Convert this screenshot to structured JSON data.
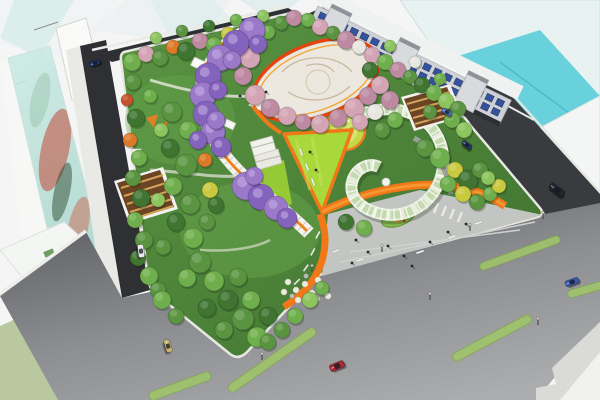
{
  "scene": {
    "description": "Aerial architectural rendering of an urban pocket-park masterplan at a street intersection",
    "palette": {
      "parkBaseLight": "#5a9442",
      "parkBaseDark": "#3f7230",
      "asphaltDark": "#2f3033",
      "boulevardDark": "#66676b",
      "boulevardLight": "#a9aaac",
      "lawnLime": "#a9d83a",
      "pathOrange": "#f07818",
      "ringRed": "#e8430f",
      "plazaWhite": "#ece8df",
      "plazaGray": "#c2c5c1",
      "glassTeal": "#62cfd9",
      "glassPale": "#e8f3f1",
      "median": "#9fc36b",
      "timberRoof": "#6b4423",
      "timberStripe": "#d2a35c",
      "g1": "#5a9440",
      "g2": "#6fae4c",
      "g3": "#3f7431",
      "g4": "#8cc45e",
      "yl": "#c9c93f",
      "or": "#dd7a28",
      "rs": "#c4522a",
      "pk": "#d3a4b4",
      "pk2": "#bd8aa2",
      "wh": "#e7e6df",
      "vi": "#9a79c9",
      "vi2": "#8463bd"
    },
    "terrace_building": {
      "cols": 18,
      "rows": 2,
      "window_color": "#27489a"
    },
    "trees": [
      [
        132,
        62,
        9,
        "g2"
      ],
      [
        146,
        54,
        8,
        "pk"
      ],
      [
        160,
        58,
        8,
        "g1"
      ],
      [
        173,
        47,
        7,
        "or"
      ],
      [
        186,
        51,
        9,
        "g3"
      ],
      [
        200,
        41,
        8,
        "pk2"
      ],
      [
        214,
        45,
        8,
        "g2"
      ],
      [
        228,
        34,
        7,
        "yl"
      ],
      [
        241,
        38,
        8,
        "g1"
      ],
      [
        255,
        28,
        8,
        "pk"
      ],
      [
        268,
        32,
        7,
        "g2"
      ],
      [
        281,
        23,
        7,
        "g1"
      ],
      [
        294,
        18,
        8,
        "pk2"
      ],
      [
        156,
        38,
        6,
        "g4"
      ],
      [
        182,
        31,
        6,
        "g1"
      ],
      [
        209,
        26,
        6,
        "g3"
      ],
      [
        236,
        20,
        6,
        "g2"
      ],
      [
        263,
        16,
        6,
        "g4"
      ],
      [
        308,
        20,
        7,
        "g2"
      ],
      [
        320,
        27,
        8,
        "pk"
      ],
      [
        333,
        33,
        7,
        "g1"
      ],
      [
        346,
        40,
        9,
        "pk2"
      ],
      [
        359,
        47,
        7,
        "wh"
      ],
      [
        372,
        55,
        8,
        "pk"
      ],
      [
        385,
        62,
        8,
        "g2"
      ],
      [
        398,
        70,
        8,
        "pk2"
      ],
      [
        410,
        77,
        7,
        "g1"
      ],
      [
        422,
        85,
        8,
        "g3"
      ],
      [
        434,
        93,
        8,
        "g2"
      ],
      [
        446,
        101,
        8,
        "g4"
      ],
      [
        458,
        109,
        8,
        "g1"
      ],
      [
        390,
        46,
        6,
        "g4"
      ],
      [
        415,
        62,
        6,
        "wh"
      ],
      [
        440,
        79,
        6,
        "g2"
      ],
      [
        250,
        58,
        10,
        "pk"
      ],
      [
        243,
        76,
        9,
        "pk2"
      ],
      [
        255,
        95,
        10,
        "pk"
      ],
      [
        270,
        108,
        9,
        "pk2"
      ],
      [
        287,
        116,
        9,
        "pk"
      ],
      [
        303,
        122,
        8,
        "pk2"
      ],
      [
        320,
        124,
        9,
        "pk"
      ],
      [
        338,
        118,
        9,
        "pk2"
      ],
      [
        354,
        108,
        10,
        "pk"
      ],
      [
        368,
        96,
        9,
        "pk2"
      ],
      [
        380,
        85,
        9,
        "pk"
      ],
      [
        390,
        100,
        9,
        "pk2"
      ],
      [
        375,
        112,
        8,
        "wh"
      ],
      [
        360,
        122,
        8,
        "pk"
      ],
      [
        395,
        120,
        8,
        "g2"
      ],
      [
        382,
        130,
        8,
        "g1"
      ],
      [
        370,
        70,
        8,
        "g3"
      ],
      [
        430,
        112,
        7,
        "g1"
      ],
      [
        452,
        120,
        8,
        "g2"
      ],
      [
        464,
        130,
        8,
        "g4"
      ],
      [
        133,
        82,
        8,
        "g1"
      ],
      [
        127,
        100,
        6,
        "rs"
      ],
      [
        136,
        118,
        9,
        "g3"
      ],
      [
        130,
        140,
        7,
        "or"
      ],
      [
        139,
        158,
        8,
        "g2"
      ],
      [
        133,
        178,
        8,
        "g1"
      ],
      [
        141,
        198,
        9,
        "g3"
      ],
      [
        135,
        220,
        8,
        "g2"
      ],
      [
        144,
        240,
        9,
        "g1"
      ],
      [
        138,
        258,
        8,
        "g3"
      ],
      [
        149,
        276,
        9,
        "g2"
      ],
      [
        158,
        290,
        8,
        "g1"
      ],
      [
        172,
        112,
        10,
        "g1"
      ],
      [
        188,
        130,
        9,
        "g2"
      ],
      [
        170,
        148,
        9,
        "g3"
      ],
      [
        186,
        165,
        11,
        "g1"
      ],
      [
        173,
        186,
        9,
        "g2"
      ],
      [
        190,
        204,
        10,
        "g1"
      ],
      [
        176,
        222,
        9,
        "g3"
      ],
      [
        193,
        238,
        10,
        "g2"
      ],
      [
        207,
        222,
        8,
        "g1"
      ],
      [
        210,
        190,
        8,
        "yl"
      ],
      [
        205,
        160,
        7,
        "or"
      ],
      [
        216,
        205,
        8,
        "g3"
      ],
      [
        161,
        130,
        7,
        "g4"
      ],
      [
        158,
        200,
        7,
        "g4"
      ],
      [
        163,
        247,
        8,
        "g1"
      ],
      [
        150,
        96,
        7,
        "g2"
      ],
      [
        200,
        262,
        11,
        "g1"
      ],
      [
        214,
        281,
        10,
        "g2"
      ],
      [
        228,
        300,
        10,
        "g3"
      ],
      [
        243,
        319,
        11,
        "g1"
      ],
      [
        257,
        337,
        10,
        "g2"
      ],
      [
        224,
        330,
        9,
        "g1"
      ],
      [
        207,
        308,
        9,
        "g3"
      ],
      [
        187,
        278,
        9,
        "g2"
      ],
      [
        238,
        277,
        9,
        "g1"
      ],
      [
        251,
        300,
        9,
        "g2"
      ],
      [
        268,
        316,
        9,
        "g3"
      ],
      [
        282,
        330,
        8,
        "g1"
      ],
      [
        295,
        316,
        8,
        "g2"
      ],
      [
        268,
        342,
        8,
        "g1"
      ],
      [
        162,
        300,
        9,
        "g2"
      ],
      [
        176,
        316,
        8,
        "g1"
      ],
      [
        310,
        300,
        8,
        "g4"
      ],
      [
        322,
        288,
        7,
        "g2"
      ],
      [
        346,
        222,
        8,
        "g3"
      ],
      [
        364,
        228,
        8,
        "g2"
      ],
      [
        425,
        148,
        9,
        "g1"
      ],
      [
        440,
        158,
        10,
        "g2"
      ],
      [
        455,
        170,
        8,
        "yl"
      ],
      [
        468,
        180,
        10,
        "g3"
      ],
      [
        480,
        170,
        8,
        "g1"
      ],
      [
        448,
        184,
        8,
        "g2"
      ],
      [
        463,
        194,
        8,
        "yl"
      ],
      [
        477,
        202,
        8,
        "g1"
      ],
      [
        490,
        194,
        7,
        "g2"
      ],
      [
        499,
        186,
        7,
        "yl"
      ],
      [
        488,
        178,
        7,
        "g4"
      ]
    ],
    "wisteria": [
      [
        252,
        30,
        13
      ],
      [
        236,
        43,
        13
      ],
      [
        220,
        58,
        13
      ],
      [
        208,
        76,
        13
      ],
      [
        203,
        95,
        13
      ],
      [
        206,
        114,
        13
      ],
      [
        213,
        132,
        12
      ],
      [
        221,
        147,
        10
      ],
      [
        246,
        186,
        14
      ],
      [
        261,
        197,
        13
      ],
      [
        276,
        208,
        12
      ],
      [
        287,
        218,
        10
      ],
      [
        232,
        60,
        9
      ],
      [
        218,
        90,
        9
      ],
      [
        216,
        120,
        9
      ],
      [
        258,
        44,
        9
      ],
      [
        254,
        176,
        9
      ],
      [
        198,
        140,
        9
      ]
    ],
    "cars": [
      {
        "name": "sedan-dark-nw",
        "x": 95,
        "y": 63,
        "rot": -22,
        "len": 11,
        "wid": 5,
        "body": "#223064"
      },
      {
        "name": "sedan-white-left-street",
        "x": 141,
        "y": 251,
        "rot": 82,
        "len": 13,
        "wid": 6,
        "body": "#e9eaec"
      },
      {
        "name": "sedan-gold",
        "x": 168,
        "y": 346,
        "rot": 72,
        "len": 13,
        "wid": 6,
        "body": "#c9b469"
      },
      {
        "name": "sedan-red",
        "x": 337,
        "y": 366,
        "rot": -22,
        "len": 15,
        "wid": 7,
        "body": "#a62b30"
      },
      {
        "name": "sedan-blue",
        "x": 572,
        "y": 282,
        "rot": -20,
        "len": 14,
        "wid": 6,
        "body": "#3a57a8"
      },
      {
        "name": "van-dark",
        "x": 557,
        "y": 190,
        "rot": 36,
        "len": 17,
        "wid": 7,
        "body": "#23252c"
      },
      {
        "name": "sedan-blue-north",
        "x": 447,
        "y": 112,
        "rot": 28,
        "len": 11,
        "wid": 5,
        "body": "#4a67b2"
      },
      {
        "name": "sedan-navy-east",
        "x": 467,
        "y": 145,
        "rot": 36,
        "len": 11,
        "wid": 5,
        "body": "#2a3560"
      }
    ],
    "medians": [
      [
        272,
        360,
        105,
        9,
        -35
      ],
      [
        492,
        338,
        88,
        9,
        -28
      ],
      [
        520,
        253,
        85,
        8,
        -20
      ],
      [
        588,
        289,
        42,
        8,
        -16
      ],
      [
        180,
        386,
        65,
        9,
        -20
      ]
    ],
    "people": [
      [
        356,
        240
      ],
      [
        368,
        252
      ],
      [
        388,
        246
      ],
      [
        404,
        256
      ],
      [
        430,
        242
      ],
      [
        448,
        232
      ],
      [
        466,
        224
      ],
      [
        352,
        263
      ],
      [
        412,
        266
      ],
      [
        310,
        152
      ],
      [
        316,
        170
      ],
      [
        240,
        96
      ],
      [
        266,
        92
      ]
    ],
    "benches": [
      [
        336,
        251,
        -22
      ],
      [
        452,
        237,
        -20
      ],
      [
        478,
        223,
        -20
      ],
      [
        301,
        152,
        70
      ],
      [
        307,
        167,
        70
      ],
      [
        313,
        182,
        70
      ],
      [
        360,
        260,
        -20
      ],
      [
        420,
        252,
        -20
      ]
    ],
    "lamps": [
      [
        312,
        272
      ],
      [
        382,
        252
      ],
      [
        470,
        231
      ],
      [
        543,
        219
      ],
      [
        538,
        325
      ],
      [
        430,
        300
      ],
      [
        262,
        360
      ]
    ],
    "flowers": [
      [
        288,
        282
      ],
      [
        296,
        290
      ],
      [
        305,
        284
      ],
      [
        312,
        293
      ],
      [
        320,
        287
      ],
      [
        328,
        296
      ],
      [
        298,
        300
      ],
      [
        310,
        302
      ],
      [
        284,
        292
      ],
      [
        318,
        280
      ]
    ],
    "rocks": [
      [
        292,
        296
      ],
      [
        318,
        299
      ],
      [
        306,
        276
      ]
    ]
  }
}
